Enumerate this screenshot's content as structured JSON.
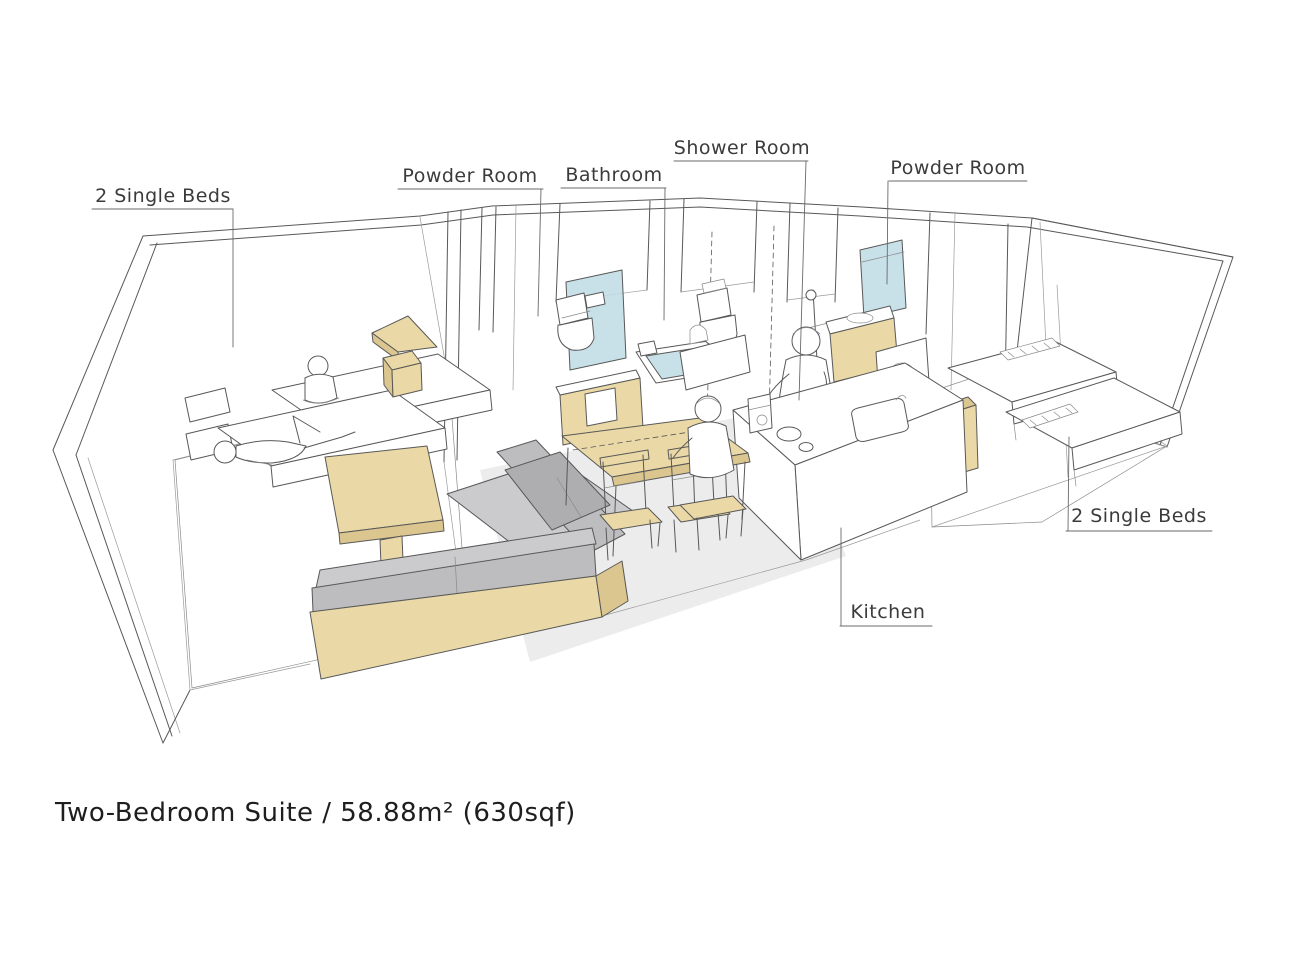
{
  "title": "Two-Bedroom Suite / 58.88m² (630sqf)",
  "colors": {
    "wood": "#ead9a6",
    "wood_dark": "#dcc68f",
    "sofa_gray": "#bdbdc0",
    "sofa_gray_light": "#cbcbce",
    "sofa_gray_dark": "#aeaeb1",
    "water_blue": "#bedbe4",
    "carpet": "#ececec",
    "line": "#585858",
    "label_text": "#3b3b3b"
  },
  "labels": {
    "beds_left": "2 Single Beds",
    "powder_left": "Powder Room",
    "bathroom": "Bathroom",
    "shower_room": "Shower Room",
    "powder_right": "Powder Room",
    "beds_right": "2 Single Beds",
    "kitchen": "Kitchen"
  }
}
